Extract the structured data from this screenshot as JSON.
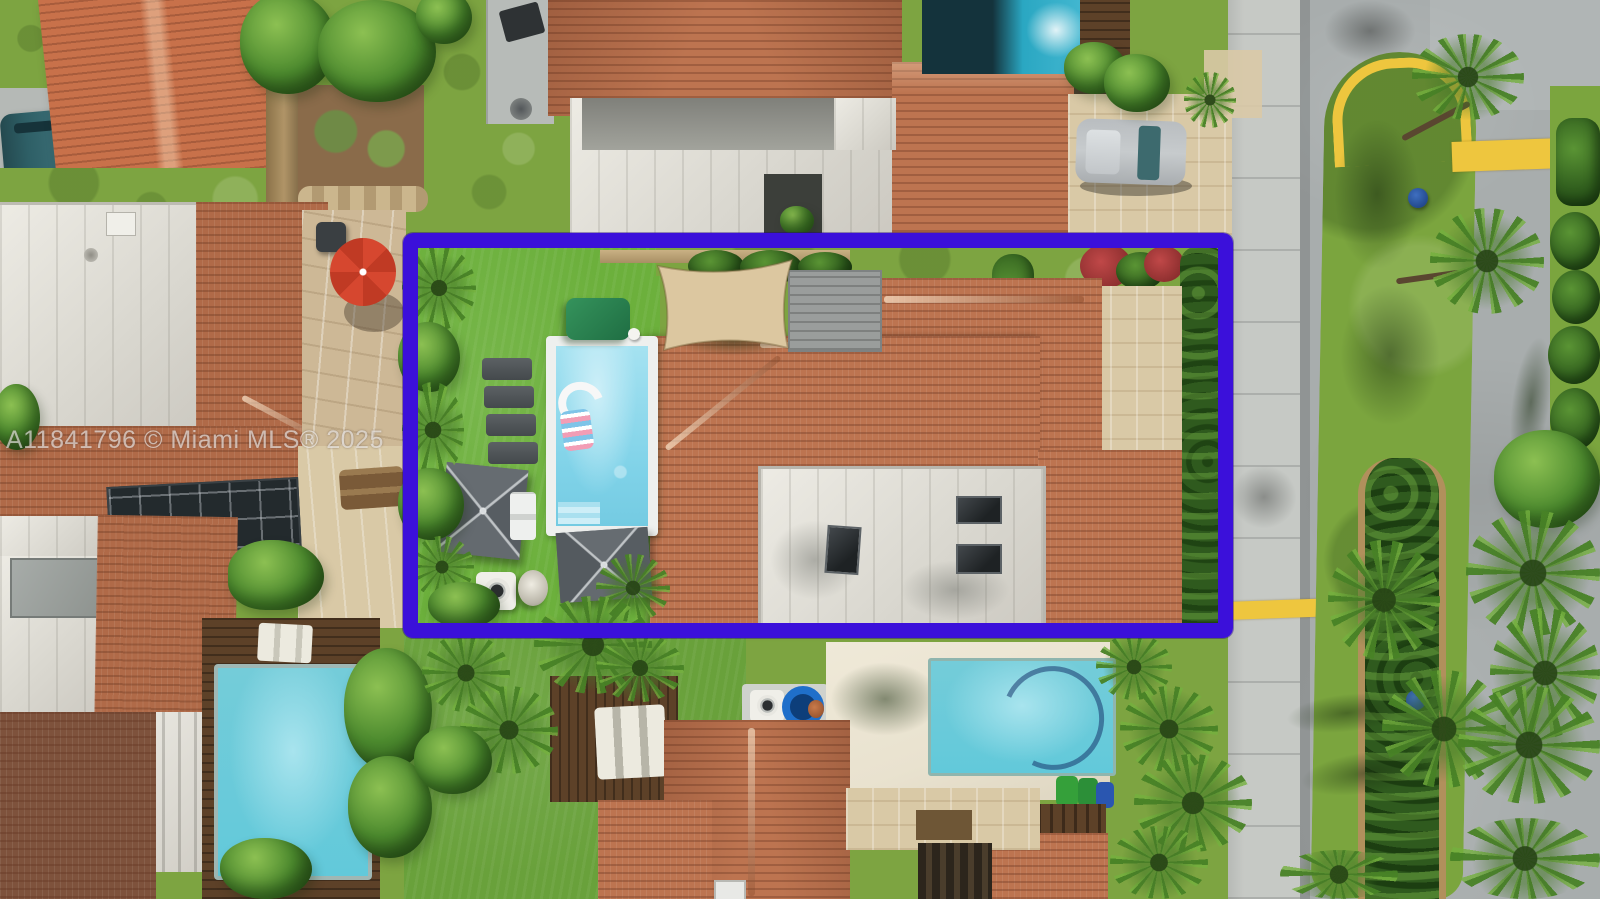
{
  "meta": {
    "type": "aerial-real-estate-photo",
    "width": 1600,
    "height": 899
  },
  "watermark": {
    "text": "A11841796 © Miami MLS® 2025"
  },
  "highlight_box": {
    "purpose": "property-boundary-outline",
    "color": "#3b10da"
  },
  "colors": {
    "highlight": "#3b10da",
    "turf": "#6cb03c",
    "lawn": "#7da441",
    "tile": "#bd7450",
    "tileOrange": "#c8714a",
    "tileMid": "#b06a48",
    "tileBrown": "#7e523c",
    "flat": "#e6e4dd",
    "flatDark": "#97988f",
    "water": "#8fd9ec",
    "waterDeep": "#62c9da",
    "waterTeal": "#2aa7c2",
    "sail": "#dcc7a0",
    "woodDark": "#5d4128",
    "deckGray": "#9a9d9c",
    "beige": "#d9c9a6",
    "stone": "#cdb896",
    "cream": "#e9e2cf",
    "asphalt": "#a8adad",
    "sidewalk": "#c6c9c5",
    "yellow": "#eec63e",
    "medianGrass": "#7ba53e",
    "hedge": "#33621f",
    "foliage": "#4c8a2e",
    "foliageLight": "#83b945",
    "umbrella": "#60666b",
    "umbrellaRed": "#d6472f",
    "carTeal": "#2e5f66",
    "carSilver": "#c7cbcd"
  },
  "scene": {
    "highlighted_property": {
      "yard": "artificial turf backyard",
      "features": [
        "rectangular swimming pool with white coping",
        "two pool floats",
        "row of lounge chairs",
        "square tan shade sail",
        "gray wood deck",
        "two dark-gray square patio umbrellas",
        "green storage bench",
        "AC unit",
        "hose reel",
        "terracotta tile hip roofs",
        "white flat roof with three skylights",
        "paver side patio",
        "tropical plants along fence"
      ]
    },
    "neighborhood": {
      "street_side": "right",
      "street_features": [
        "curved two-lane road",
        "grass median with hedge and palm trees",
        "yellow curb marking around median tip",
        "yellow crosswalk stripe",
        "concrete sidewalk",
        "blue street sign"
      ],
      "neighbors": [
        "terracotta tile-roof houses",
        "three additional swimming pools",
        "red patio umbrella on stone patio",
        "black screened enclosure",
        "silver SUV in paver driveway",
        "teal car in driveway",
        "dark wood pool decks",
        "green and blue trash bins"
      ]
    }
  }
}
